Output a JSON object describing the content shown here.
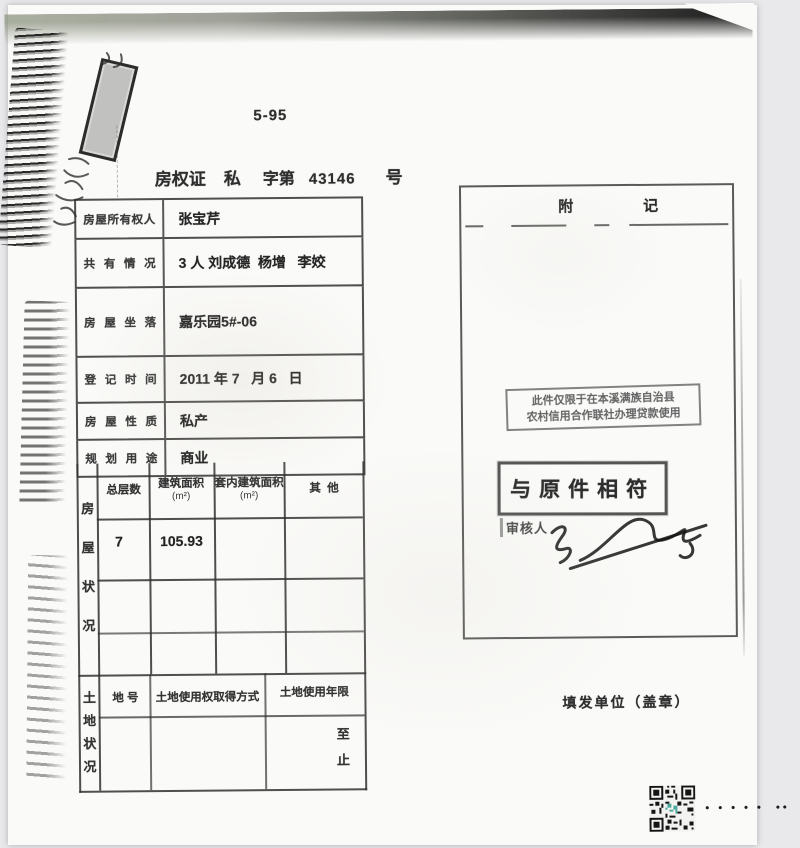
{
  "header": {
    "form_code": "5-95",
    "cert_type": "房权证",
    "category": "私",
    "series_label": "字第",
    "serial_number": "43146",
    "number_suffix": "号"
  },
  "info_table": {
    "rows": [
      {
        "label": "房屋所有权人",
        "value": "张宝芹"
      },
      {
        "label": "共有情况",
        "value": "3 人 刘成德  杨增   李姣"
      },
      {
        "label": "房屋坐落",
        "value": "嘉乐园5#-06"
      },
      {
        "label": "登记时间",
        "value": "2011 年 7   月 6   日"
      },
      {
        "label": "房屋性质",
        "value": "私产"
      },
      {
        "label": "规划用途",
        "value": "商业"
      }
    ]
  },
  "house_status": {
    "side_label": "房屋状况",
    "columns": [
      {
        "name": "总层数",
        "unit": ""
      },
      {
        "name": "建筑面积",
        "unit": "(m²)"
      },
      {
        "name": "套内建筑面积",
        "unit": "(m²)"
      },
      {
        "name": "其  他",
        "unit": ""
      }
    ],
    "data_row": {
      "floors": "7",
      "floor_area": "105.93",
      "inner_area": "",
      "other": ""
    }
  },
  "land_status": {
    "side_label": "土地状况",
    "columns": [
      "地 号",
      "土地使用权取得方式",
      "土地使用年限"
    ],
    "term_to": "至",
    "term_stop": "止"
  },
  "notes": {
    "title_a": "附",
    "title_b": "记",
    "restriction_line1": "此件仅限于在本溪满族自治县",
    "restriction_line2": "农村信用合作联社办理贷款使用",
    "match_stamp": "与原件相符",
    "reviewer_label": "审核人"
  },
  "footer": {
    "issuer_label": "填发单位（盖章）",
    "dots": "• • • • •  ••"
  }
}
